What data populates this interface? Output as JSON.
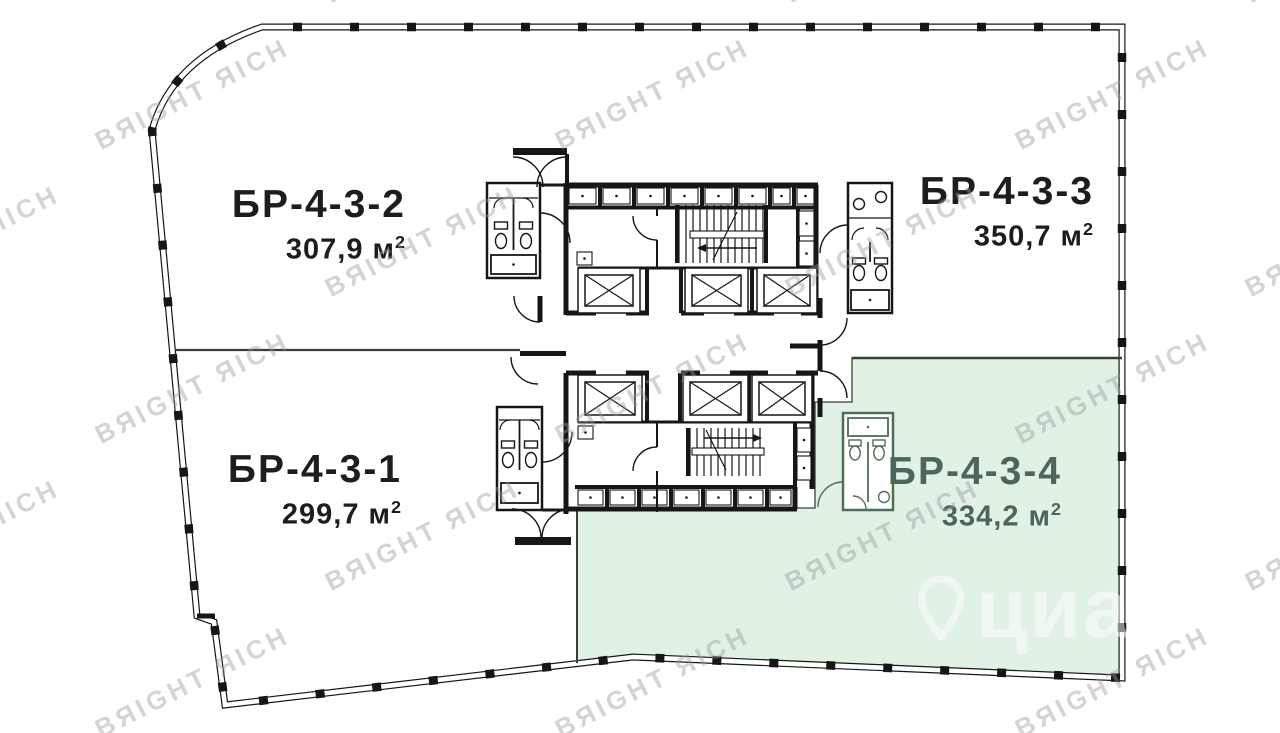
{
  "plan": {
    "units": [
      {
        "id": "БР-4-3-2",
        "area_value": "307,9",
        "area_unit": "м",
        "area_exp": "2",
        "highlighted": false
      },
      {
        "id": "БР-4-3-3",
        "area_value": "350,7",
        "area_unit": "м",
        "area_exp": "2",
        "highlighted": false
      },
      {
        "id": "БР-4-3-1",
        "area_value": "299,7",
        "area_unit": "м",
        "area_exp": "2",
        "highlighted": false
      },
      {
        "id": "БР-4-3-4",
        "area_value": "334,2",
        "area_unit": "м",
        "area_exp": "2",
        "highlighted": true
      }
    ],
    "colors": {
      "ink": "#161616",
      "highlight_fill": "#e1f1e3",
      "highlight_ink": "#4e6e58",
      "highlight_text": "#4d665a",
      "divider": "#3c3c3c"
    }
  },
  "watermarks": {
    "brand": {
      "text": "BЯIGHT ЯICH",
      "color": "#9a9a9a"
    },
    "listing": {
      "text": "циан",
      "color": "#ffffff"
    }
  }
}
